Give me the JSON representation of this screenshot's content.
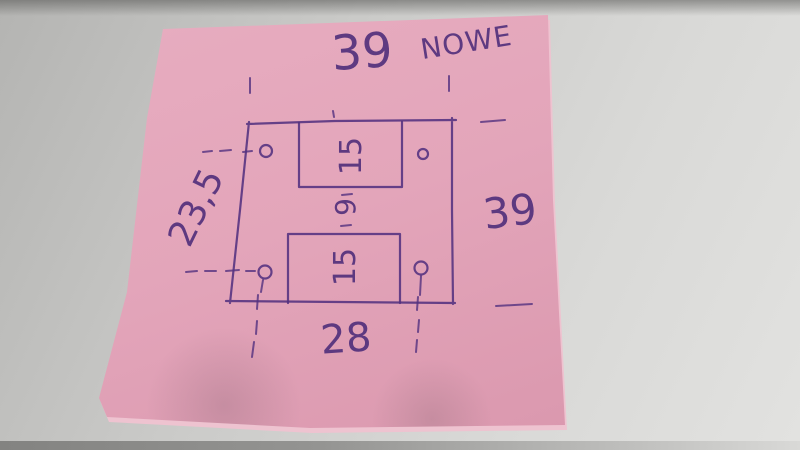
{
  "photo": {
    "surface_color": "#d4d4d2",
    "table_edge_color": "#7c7c7a"
  },
  "sticky_note": {
    "paper_color": "#e3a5ba",
    "ink_color": "#4f2e7a",
    "heading": "NOWE",
    "dimensions": {
      "top_width": "39",
      "right_height": "39",
      "left_height": "23,5",
      "bottom_width": "28",
      "top_slot_width": "15",
      "bottom_slot_width": "15",
      "center_gap": "9"
    },
    "sketch": {
      "shape": "square plate with four corner holes and two rectangular slots",
      "holes": 4,
      "slots": 2
    }
  }
}
